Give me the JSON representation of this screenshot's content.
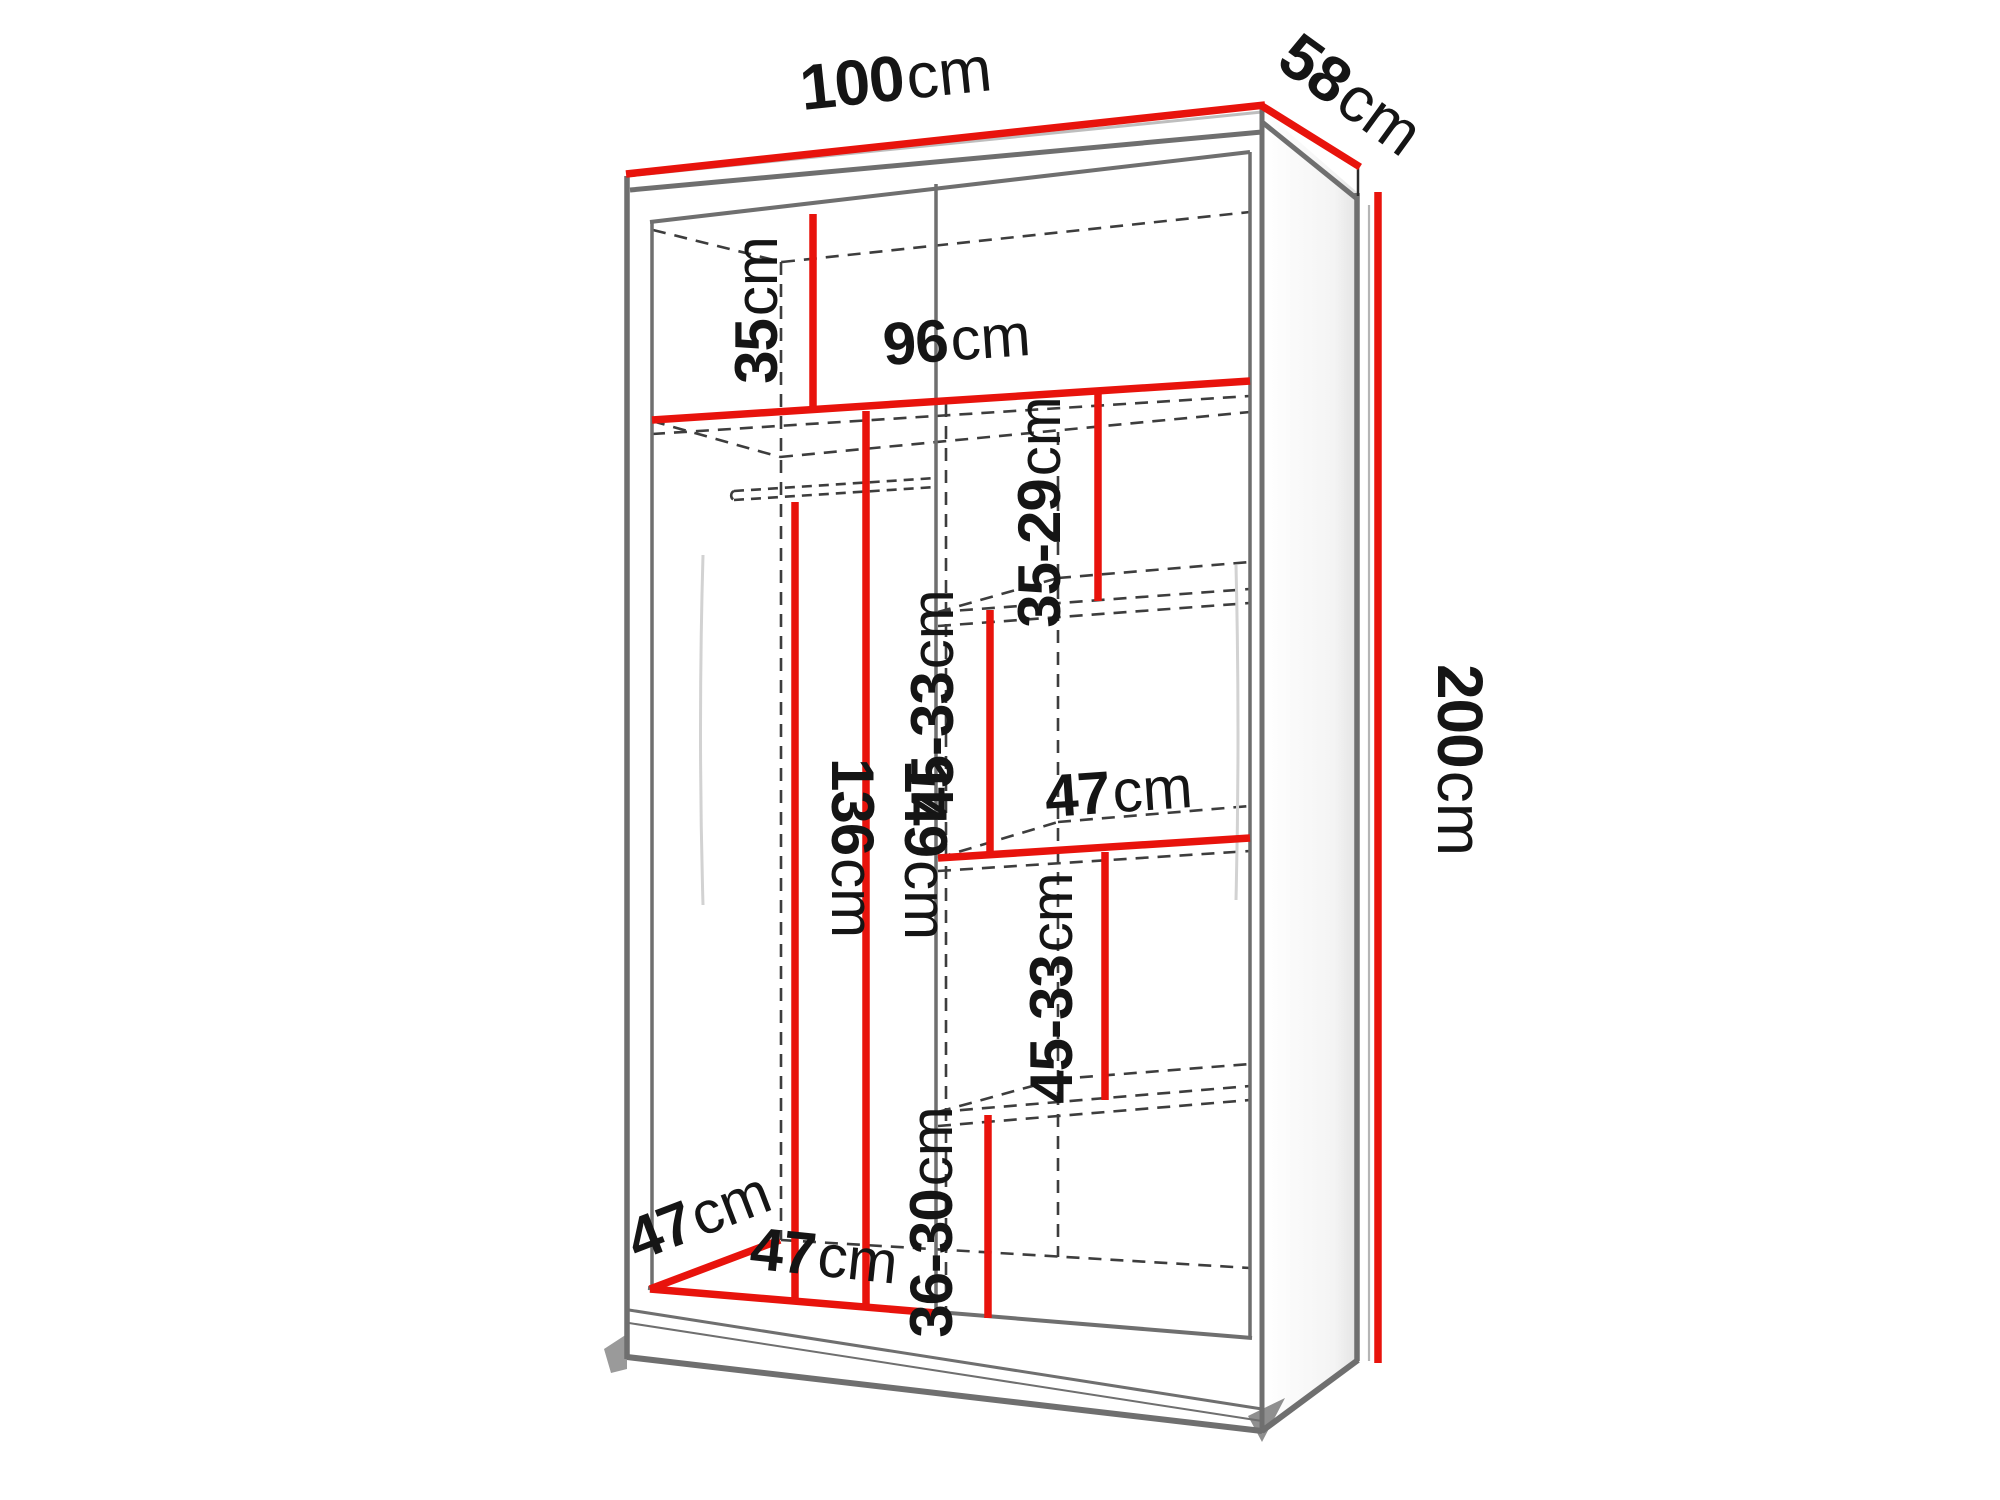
{
  "diagram": {
    "title": "wardrobe-dimension-diagram",
    "unit_system": "cm",
    "labels": {
      "total_width": {
        "value": "100",
        "unit": "cm"
      },
      "total_depth": {
        "value": "58",
        "unit": "cm"
      },
      "total_height": {
        "value": "200",
        "unit": "cm"
      },
      "top_shelf_height": {
        "value": "35",
        "unit": "cm"
      },
      "interior_width": {
        "value": "96",
        "unit": "cm"
      },
      "right_top_section_height": {
        "value": "35-29",
        "unit": "cm"
      },
      "right_upper_section_height": {
        "value": "45-33",
        "unit": "cm"
      },
      "right_shelf_width": {
        "value": "47",
        "unit": "cm"
      },
      "hanging_space_height": {
        "value": "136",
        "unit": "cm"
      },
      "left_section_height": {
        "value": "149",
        "unit": "cm"
      },
      "right_lower_section_height": {
        "value": "45-33",
        "unit": "cm"
      },
      "right_bottom_section_height": {
        "value": "36-30",
        "unit": "cm"
      },
      "interior_depth": {
        "value": "47",
        "unit": "cm"
      },
      "left_section_width": {
        "value": "47",
        "unit": "cm"
      }
    },
    "colors": {
      "dimension_line": "#e8130c",
      "outline": "#6f6f6f",
      "hidden_line": "#3d3d3d",
      "label_text": "#151515",
      "background": "#ffffff"
    }
  }
}
